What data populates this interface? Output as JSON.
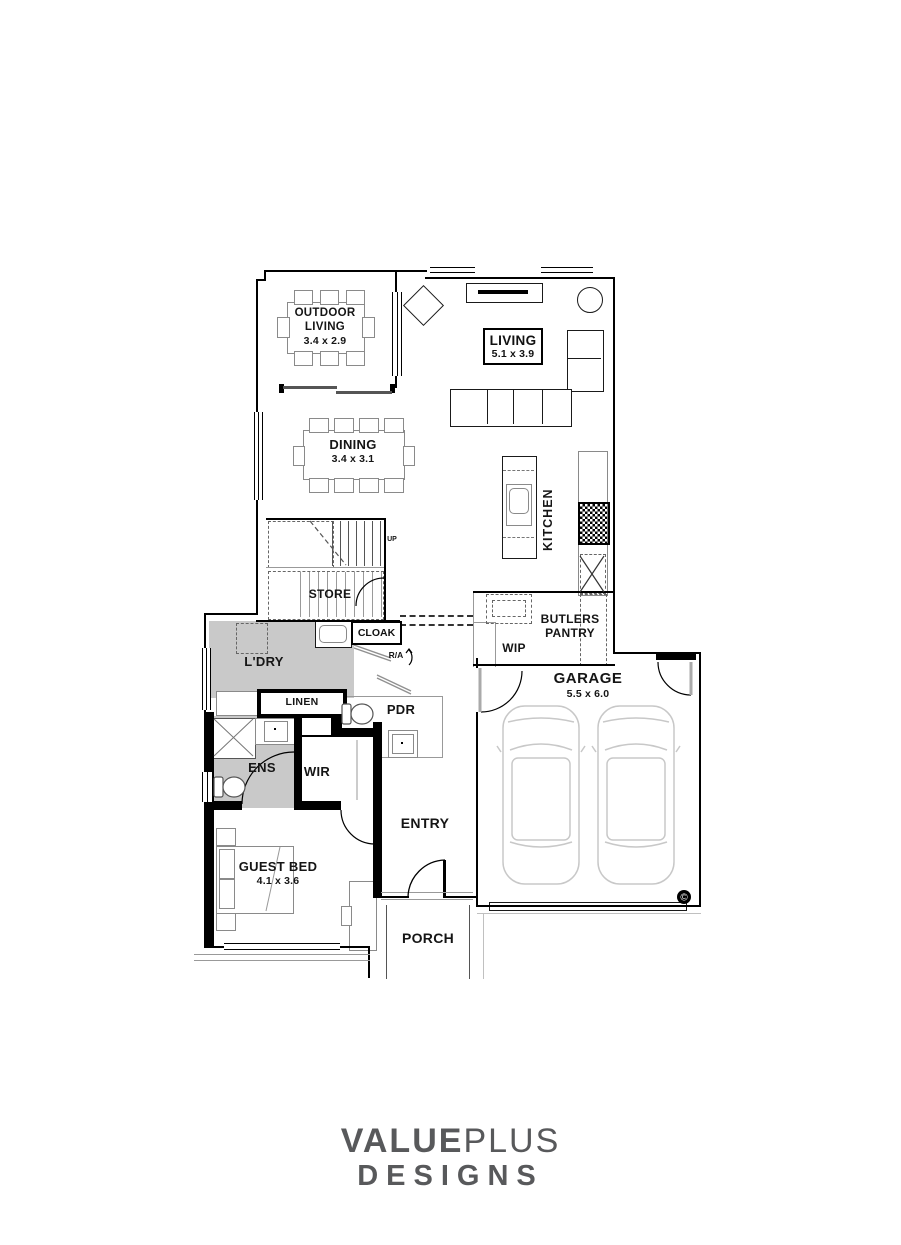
{
  "plan": {
    "rooms": {
      "outdoor_living": {
        "name": "OUTDOOR LIVING",
        "dims": "3.4 x 2.9"
      },
      "living": {
        "name": "LIVING",
        "dims": "5.1 x 3.9"
      },
      "dining": {
        "name": "DINING",
        "dims": "3.4 x 3.1"
      },
      "kitchen": {
        "name": "KITCHEN"
      },
      "store": {
        "name": "STORE"
      },
      "stairs": {
        "direction_label": "UP"
      },
      "cloak": {
        "name": "CLOAK"
      },
      "return_air": {
        "name": "R/A"
      },
      "laundry": {
        "name": "L'DRY"
      },
      "linen": {
        "name": "LINEN"
      },
      "powder_room": {
        "name": "PDR"
      },
      "walk_in_pantry": {
        "name": "WIP"
      },
      "butlers_pantry": {
        "name": "BUTLERS PANTRY"
      },
      "garage": {
        "name": "GARAGE",
        "dims": "5.5 x 6.0"
      },
      "ensuite": {
        "name": "ENS"
      },
      "walk_in_robe": {
        "name": "WIR"
      },
      "entry": {
        "name": "ENTRY"
      },
      "guest_bed": {
        "name": "GUEST BED",
        "dims": "4.1 x 3.6"
      },
      "porch": {
        "name": "PORCH"
      }
    },
    "copyright_symbol": "©"
  },
  "branding": {
    "logo_line1_bold": "VALUE",
    "logo_line1_light": "PLUS",
    "logo_line2": "DESIGNS",
    "logo_color": "#58595b"
  },
  "colors": {
    "wall": "#000000",
    "floor_shading": "#c9c9c9",
    "furniture_line": "#8a8a8a",
    "vehicle_line": "#c8c8c8"
  }
}
